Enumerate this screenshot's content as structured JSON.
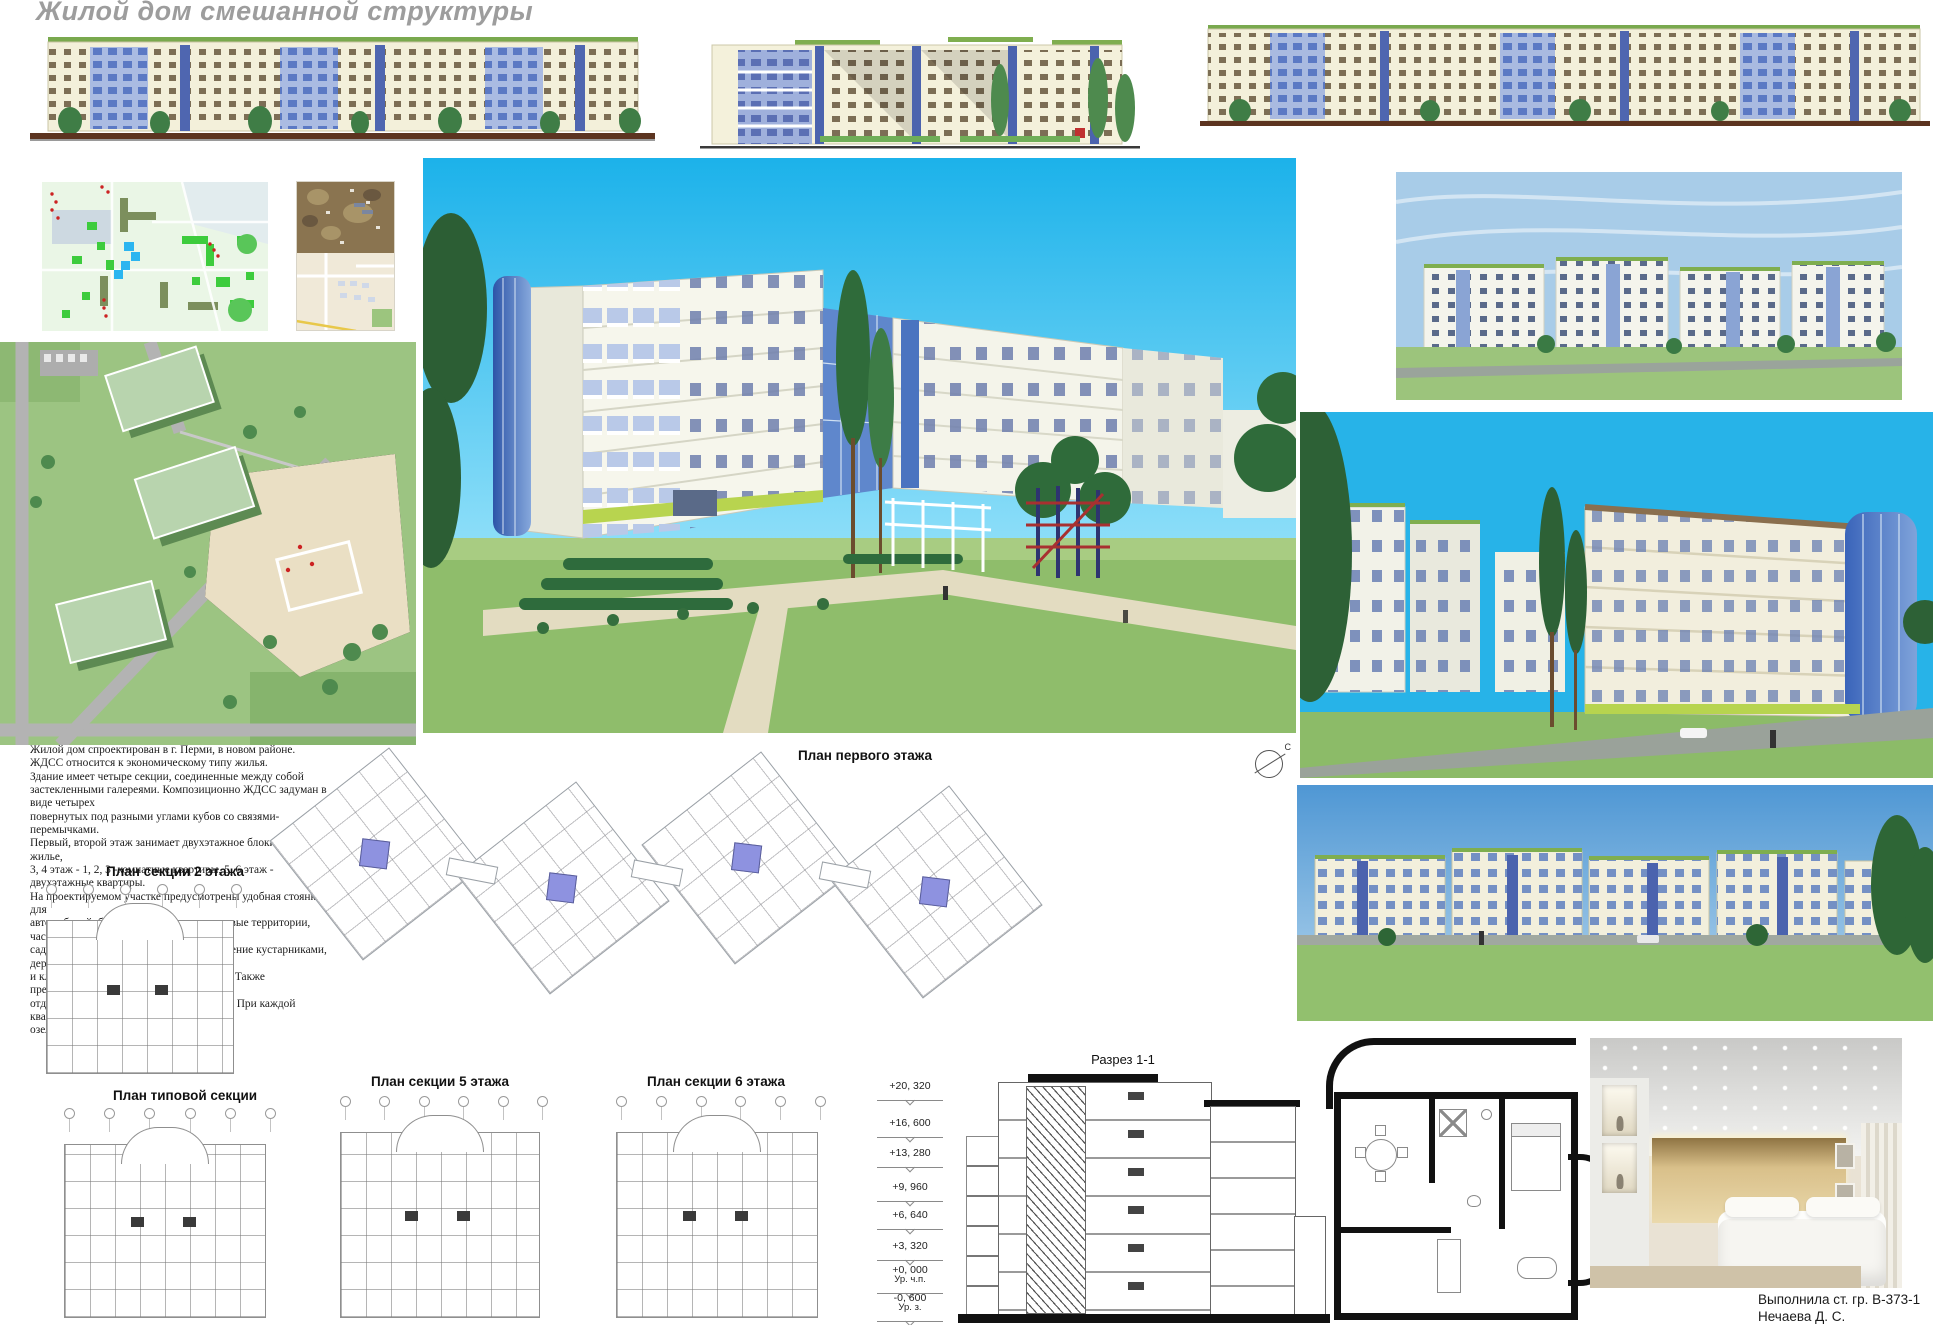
{
  "title": "Жилой дом смешанной структуры",
  "description": "Жилой дом спроектирован в г. Перми, в новом районе.\nЖДСС относится к экономическому типу жилья.\nЗдание имеет четыре секции, соединенные между собой\nзастекленными  галереями. Композиционно ЖДСС задуман в виде четырех\nповернутых под разными углами кубов со связями-перемычками.\nПервый, второй этаж занимает двухэтажное блокированное жилье,\n3, 4 этаж - 1, 2, 3 -комнатные квартиры, 5, 6 этаж - двухэтажные квартиры.\nНа проектируемом участке предусмотрены удобная стоянка для\nавтомобилей, благоустроенные преддомовые территории, частные\nсады-участки, игровые площадки, озеленение кустарниками, деревьями\nи клумбами, игровое поле, парковая зона. Также предусмотрены зоны\nотдыха как для детей, так и для взрослых. При каждой квартире предусмотены\nозелен□нные террасы или летние сады.",
  "plans": {
    "first_floor_label": "План первого этажа",
    "section2_label": "План секции 2 этажа",
    "typical_label": "План типовой секции",
    "section5_label": "План секции 5 этажа",
    "section6_label": "План секции 6 этажа"
  },
  "section_view": {
    "label": "Разрез 1-1",
    "marks": [
      {
        "value": "+20, 320"
      },
      {
        "value": "+16, 600"
      },
      {
        "value": "+13, 280"
      },
      {
        "value": "+9, 960"
      },
      {
        "value": "+6, 640"
      },
      {
        "value": "+3, 320"
      },
      {
        "value": "+0, 000",
        "note": "Ур. ч.п."
      },
      {
        "value": "-0, 600",
        "note": "Ур. з."
      }
    ]
  },
  "compass": {
    "north_letter": "С"
  },
  "credit": {
    "line1": "Выполнила ст. гр. В-373-1",
    "line2": "Нечаева Д. С."
  },
  "colors": {
    "sky_cyan": "#29b9ec",
    "pale_sky": "#a8cce8",
    "panorama_sky": "#4f97d4",
    "lawn_green": "#8fbd6b",
    "facade_cream": "#f3f0da",
    "glass_blue": "#4b63ae",
    "roof_green": "#7fae4f",
    "stair_purple": "#8e92e0",
    "title_gray": "#9d9d9d",
    "ground_brown": "#5c3420"
  }
}
